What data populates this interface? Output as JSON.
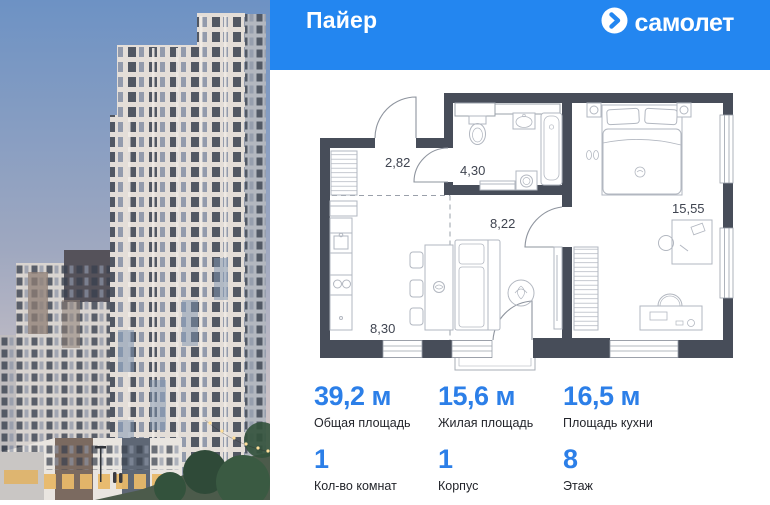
{
  "header": {
    "project_title": "Пайер",
    "brand_text": "самолет"
  },
  "photo": {
    "description": "rendering of residential towers at dusk"
  },
  "floor_plan": {
    "rooms": [
      {
        "id": "hallway",
        "area_label": "2,82"
      },
      {
        "id": "bathroom",
        "area_label": "4,30"
      },
      {
        "id": "hall",
        "area_label": "8,22"
      },
      {
        "id": "bedroom",
        "area_label": "15,55"
      },
      {
        "id": "kitchen_living",
        "area_label": "8,30"
      }
    ]
  },
  "stats": [
    {
      "value": "39,2 м",
      "label": "Общая площадь"
    },
    {
      "value": "15,6 м",
      "label": "Жилая площадь"
    },
    {
      "value": "16,5 м",
      "label": "Площадь кухни"
    }
  ],
  "details": [
    {
      "value": "1",
      "label": "Кол-во комнат"
    },
    {
      "value": "1",
      "label": "Корпус"
    },
    {
      "value": "8",
      "label": "Этаж"
    }
  ],
  "colors": {
    "accent_blue": "#2386f0",
    "value_blue": "#2c7fe8",
    "wall_dark": "#474d59",
    "furniture_line": "#b2b7c0"
  }
}
